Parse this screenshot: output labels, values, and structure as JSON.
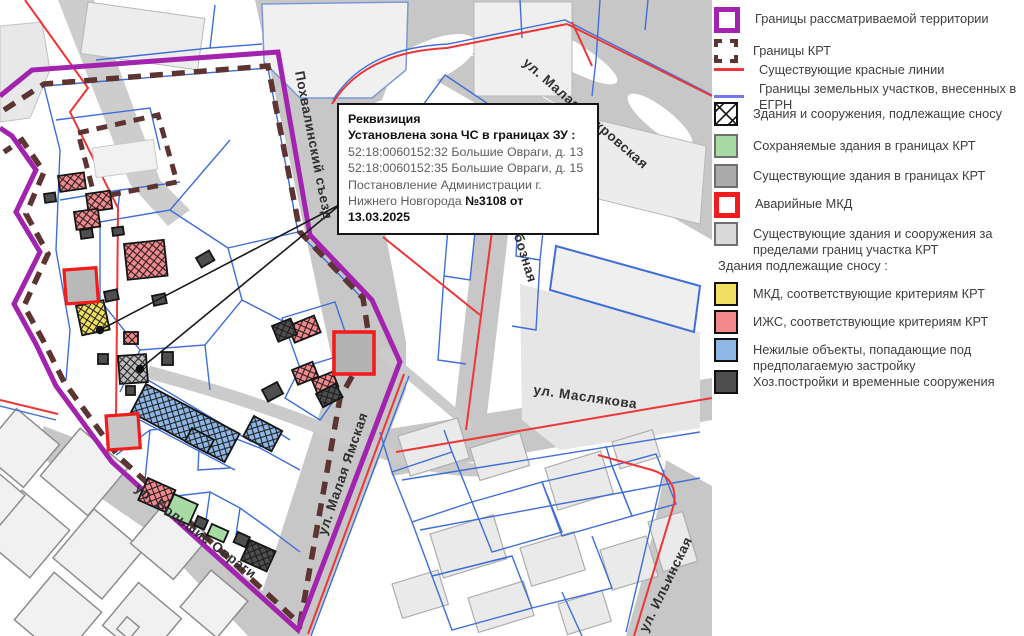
{
  "legend": {
    "items": [
      {
        "id": "territory-boundary",
        "label": "Границы рассматриваемой территории"
      },
      {
        "id": "krt-boundary",
        "label": "Границы КРТ"
      },
      {
        "id": "red-lines",
        "label": "Существующие красные линии"
      },
      {
        "id": "egrn-parcels",
        "label": "Границы земельных участков, внесенных в ЕГРН"
      },
      {
        "id": "demolish-buildings",
        "label": "Здания и сооружения, подлежащие сносу"
      },
      {
        "id": "preserved-buildings",
        "label": "Сохраняемые здания в границах КРТ"
      },
      {
        "id": "existing-in-krt",
        "label": "Существующие здания в границах КРТ"
      },
      {
        "id": "emergency-mkd",
        "label": "Аварийные МКД"
      },
      {
        "id": "existing-outside-krt",
        "label": "Существующие здания и сооружения за пределами границ участка КРТ"
      }
    ],
    "section2_title": "Здания подлежащие сносу :",
    "items2": [
      {
        "id": "mkd-krt",
        "label": "МКД, соответствующие критериям КРТ"
      },
      {
        "id": "izhs-krt",
        "label": "ИЖС, соответствующие критериям КРТ"
      },
      {
        "id": "nonresidential",
        "label": "Нежилые объекты, попадающие под предполагаемую застройку"
      },
      {
        "id": "outbuildings",
        "label": "Хоз.постройки и временные сооружения"
      }
    ]
  },
  "annotation": {
    "title": "Реквизиция",
    "line2": "Установлена зона ЧС в границах ЗУ :",
    "line3": "52:18:0060152:32 Большие Овраги, д. 13",
    "line4": "52:18:0060152:35 Большие Овраги, д. 15",
    "line5": "Постановление Администрации г.",
    "line6_normal": "Нижнего Новгорода ",
    "line6_bold": "№3108 от 13.03.2025"
  },
  "map": {
    "streets": {
      "pokhvalinsky": "Похвалинский съезд",
      "malaya_pokrovskaya": "ул. Малая Покровская",
      "oboznaya": "ул. Обозная",
      "maslyakova": "ул. Маслякова",
      "malaya_yamskaya": "ул. Малая Ямская",
      "bolshie_ovragi": "ул. Большие Овраги",
      "ilyinskaya": "ул. Ильинская"
    }
  },
  "colors": {
    "territory_boundary": "#a224ae",
    "krt_boundary": "#5c3532",
    "red_line": "#ee3537",
    "parcel_line": "#3f6ed9",
    "mkd_yellow": "#f0df63",
    "izhs_pink": "#f2898c",
    "nonres_blue": "#8fb7e5",
    "outbuilding_dark": "#4e4e4e",
    "preserved_green": "#a7dba3",
    "existing_gray": "#ababab",
    "emergency_red": "#f41b1b",
    "road_gray": "#c7c7c7"
  }
}
